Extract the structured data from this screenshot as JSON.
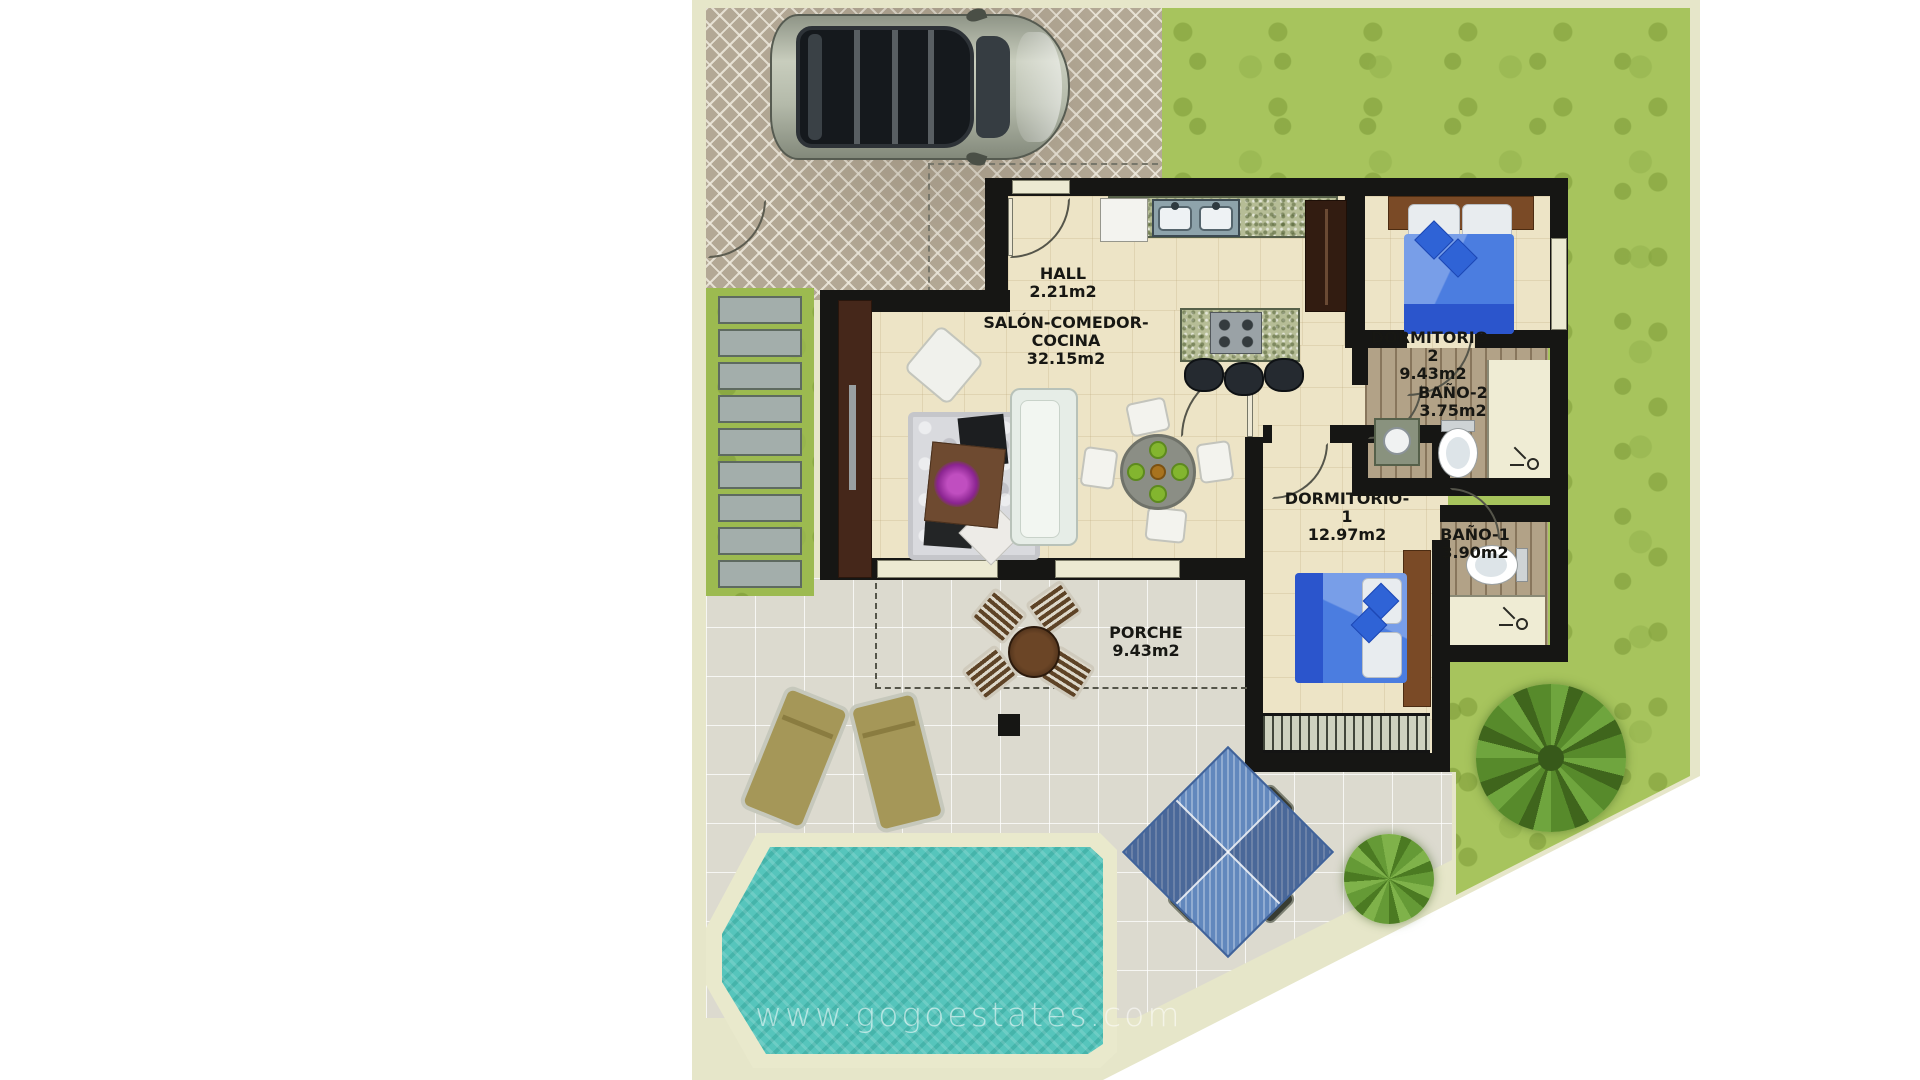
{
  "watermark": "www.gogoestates.com",
  "rooms": [
    {
      "name": "HALL",
      "area": "2.21m2"
    },
    {
      "name": "SALÓN-COMEDOR-COCINA",
      "area": "32.15m2"
    },
    {
      "name": "DORMITORIO-2",
      "area": "9.43m2"
    },
    {
      "name": "BAÑO-2",
      "area": "3.75m2"
    },
    {
      "name": "DORMITORIO-1",
      "area": "12.97m2"
    },
    {
      "name": "BAÑO-1",
      "area": "3.90m2"
    },
    {
      "name": "PORCHE",
      "area": "9.43m2"
    }
  ],
  "colors": {
    "plot_border": "#e6e6c9",
    "grass": "#a7c45d",
    "pool_water": "#56c5bc",
    "wall": "#161614",
    "interior_floor": "#ede4c6",
    "terrace": "#dcdacf",
    "bed_blue": "#4b7de0",
    "parasol_blue": "#6288bd"
  }
}
